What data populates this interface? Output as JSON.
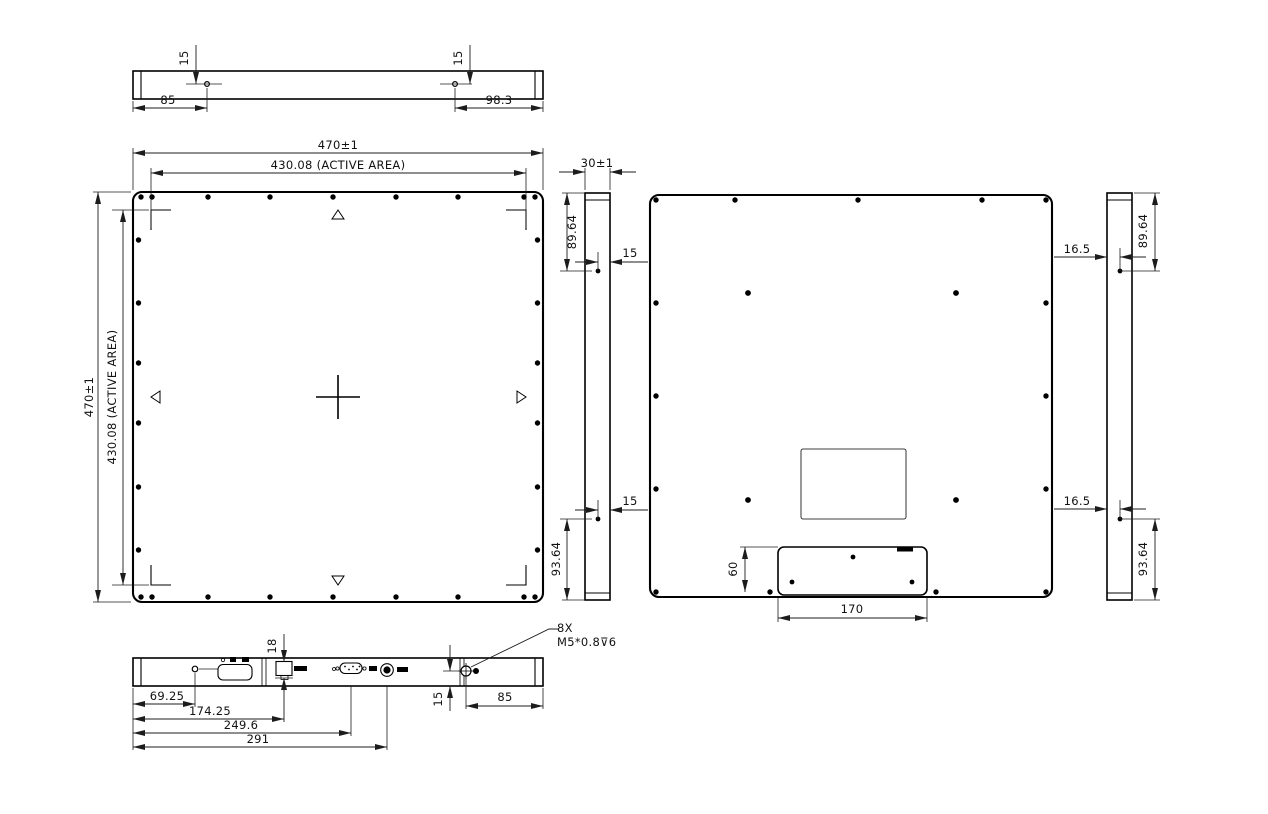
{
  "drawing": {
    "top_view": {
      "dim_hole_depth_left": "15",
      "dim_hole_depth_right": "15",
      "dim_left_edge_to_hole": "85",
      "dim_right_edge_to_hole": "98.3"
    },
    "front_view": {
      "dim_overall_width": "470±1",
      "dim_active_area_width": "430.08 (ACTIVE AREA)",
      "dim_overall_height": "470±1",
      "dim_active_area_height": "430.08 (ACTIVE AREA)"
    },
    "side_view_inner": {
      "dim_thickness": "30±1",
      "dim_top_to_hole": "89.64",
      "dim_face_to_hole_top": "15",
      "dim_face_to_hole_bottom": "15",
      "dim_bottom_to_hole": "93.64"
    },
    "back_view": {
      "dim_connector_box_height": "60",
      "dim_connector_box_width": "170"
    },
    "side_view_right": {
      "dim_top_to_hole": "89.64",
      "dim_face_to_hole_top": "16.5",
      "dim_face_to_hole_bottom": "16.5",
      "dim_bottom_to_hole": "93.64"
    },
    "bottom_view": {
      "dim_connector_offset": "18",
      "dim_hole": "69.25",
      "dim_lan_port": "174.25",
      "dim_dsub_port": "249.6",
      "dim_power_port": "291",
      "dim_hole_depth": "15",
      "dim_edge_to_hole": "85",
      "thread_callout_line1": "8X",
      "thread_callout_line2": "M5*0.8⊽6"
    }
  }
}
